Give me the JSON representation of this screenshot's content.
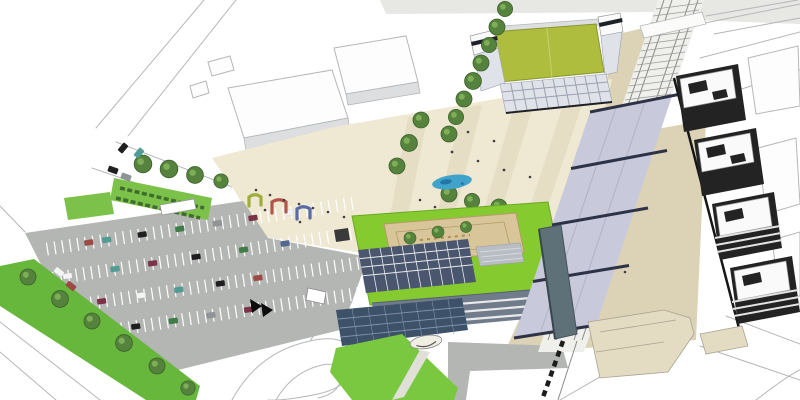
{
  "meta": {
    "title": "Aerial architectural masterplan rendering of a station district with stadium, plaza, green-roof building, parking lot and residential blocks",
    "type": "architectural-rendering",
    "view": "aerial-axonometric",
    "canvas": {
      "width": 800,
      "height": 400
    }
  },
  "colors": {
    "background": "#ffffff",
    "linework": "#b4b7ba",
    "road_gray": "#e7e7e4",
    "context_white": "#fdfdfd",
    "context_face": "#dcdedf",
    "pitch_green": "#afbd3e",
    "stand_gray": "#dfe2e9",
    "stand_line": "#9aa1af",
    "stadium_dark": "#1e2126",
    "roof_white": "#fafafa",
    "plaza_cream": "#efe8d2",
    "plaza_stripe": "#e5dec4",
    "platform_beige": "#dcd3b6",
    "walkway_gray": "#b3b6b3",
    "verge_green": "#67b73c",
    "lawn_green": "#79c840",
    "median_green": "#7cc24a",
    "hedge_dark": "#3f6d2d",
    "tree_fill": "#55833d",
    "tree_rim": "#3c6129",
    "tree_light": "#7fae58",
    "roof_green": "#85ca2f",
    "roof_edge": "#6aa824",
    "courtyard_tan": "#d8c59a",
    "court_line": "#b59a66",
    "deck_gray": "#b9bdc4",
    "solar_dark": "#4a566e",
    "solar_grid": "#e8eaec",
    "facade_glass": "#707c8c",
    "facade_band": "#e9eae9",
    "glass_dark": "#3d5168",
    "glass_line": "#7f94ad",
    "canopy_lavender": "#c8c9da",
    "canopy_beam": "#2e3246",
    "canopy_seam": "#b2b3c8",
    "tower_slate": "#5e7078",
    "rail_band": "#efefec",
    "rail_line": "#8a8a88",
    "rail_dark": "#1c1c1c",
    "dark_building": "#232323",
    "louver_light": "#e3e3e3",
    "water_blue": "#3fa3cc",
    "water_deep": "#1f6f9e",
    "arch_green": "#9ead3c",
    "arch_red": "#b2564a",
    "arch_blue": "#5b6ba6",
    "person_dark": "#3f3f3f",
    "bay_line": "#ffffff",
    "kiosk_dark": "#3a3a3a",
    "van_white": "#ffffff",
    "chevron_black": "#0d0d0d",
    "ramp_beige": "#e3dcc2",
    "ramp_line": "#aaa393",
    "car_red": "#9e4a44",
    "car_maroon": "#7c3347",
    "car_teal": "#4f9d94",
    "car_green": "#3e7d46",
    "car_black": "#1f1f1f",
    "car_gray": "#8f9496",
    "car_white": "#f4f4f4",
    "car_blue": "#53688f"
  },
  "features": [
    {
      "id": "stadium",
      "label": "Sports pitch with grandstands"
    },
    {
      "id": "central-plaza",
      "label": "Striped paved plaza with trees and fountain"
    },
    {
      "id": "plaza-art-arches",
      "label": "Three colored arch sculptures (green, red, blue)"
    },
    {
      "id": "green-roof-building",
      "label": "Building with green roof, tan courtyard and solar array"
    },
    {
      "id": "station-canopy",
      "label": "Glazed station canopy over railway with cross beams"
    },
    {
      "id": "railway-corridor",
      "label": "Hatched railway tracks running diagonally"
    },
    {
      "id": "residential-blocks",
      "label": "Row of four dark residential blocks with white roofs"
    },
    {
      "id": "parking-lot",
      "label": "Surface parking lot with marked bays and parked cars"
    },
    {
      "id": "tree-rows",
      "label": "Street tree rows, hedged median and green verges"
    },
    {
      "id": "context-buildings",
      "label": "White line-work context buildings and streets"
    }
  ],
  "counts": {
    "parked_cars": 22,
    "road_cars": 6,
    "art_arches": 3,
    "residential_blocks": 4,
    "canopy_beams": 5,
    "trees_total": 31
  }
}
